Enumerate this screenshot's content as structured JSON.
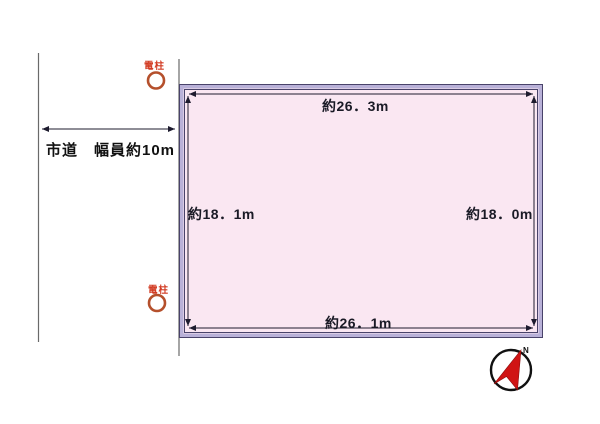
{
  "diagram": {
    "type": "land-plot-site-plan",
    "road": {
      "label": "市道　幅員約10m"
    },
    "plot": {
      "top_dim": "約26．3m",
      "right_dim": "約18．0m",
      "left_dim": "約18．1m",
      "bottom_dim": "約26．1m",
      "fill_color": "#fae7f2",
      "border_band_color": "#b9b1d8",
      "border_edge_color": "#49436a"
    },
    "poles": {
      "top_label": "電柱",
      "bottom_label": "電柱",
      "symbol_color": "#b5502c",
      "label_color": "#d23b22"
    },
    "compass": {
      "north_label": "N",
      "arrow_color": "#d01414",
      "ring_color": "#111111"
    },
    "line_color": "#1d1b2e",
    "road_line_color": "#6a6a6a"
  }
}
